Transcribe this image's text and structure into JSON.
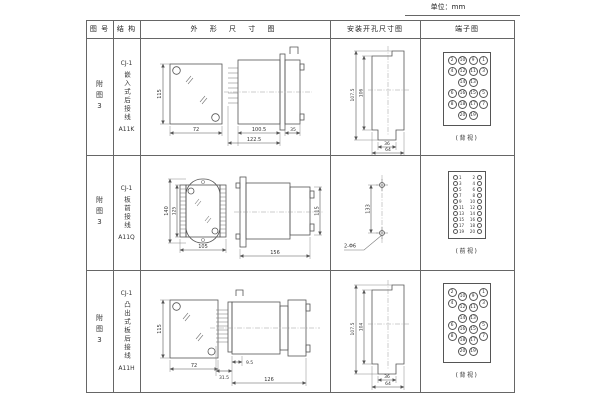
{
  "unit_label": "单位：mm",
  "header": {
    "figure": "图 号",
    "structure": "结 构",
    "outline": "外 形 尺 寸 图",
    "install": "安装开孔尺寸图",
    "terminal": "端子图"
  },
  "rows": [
    {
      "figure": "附图3",
      "structure": {
        "model": "CJ-1",
        "name": "嵌入式后接线",
        "code": "A11K"
      },
      "outline": {
        "front_height": "115",
        "front_width": "72",
        "depth_body": "100.5",
        "depth_total": "122.5",
        "front_depth": "35"
      },
      "install": {
        "outer_height": "107.5",
        "inner_height": "106",
        "inner_width": "36",
        "outer_width": "64"
      },
      "terminal": {
        "style": "grid",
        "rows": [
          [
            "2",
            "10",
            "9",
            "1"
          ],
          [
            "4",
            "12",
            "11",
            "3"
          ],
          [
            "",
            "14",
            "13",
            ""
          ],
          [
            "6",
            "16",
            "15",
            "5"
          ],
          [
            "8",
            "18",
            "17",
            "7"
          ],
          [
            "",
            "20",
            "19",
            ""
          ]
        ],
        "caption": "(背视)"
      }
    },
    {
      "figure": "附图3",
      "structure": {
        "model": "CJ-1",
        "name": "板前接线",
        "code": "A11Q"
      },
      "outline": {
        "front_height_outer": "140",
        "front_height_inner": "125",
        "front_width": "105",
        "side_length": "156",
        "side_height": "115"
      },
      "install": {
        "hole_spacing": "133",
        "hole_note": "2-Φ6"
      },
      "terminal": {
        "style": "dual",
        "pairs": [
          [
            "1",
            "2"
          ],
          [
            "3",
            "4"
          ],
          [
            "5",
            "6"
          ],
          [
            "7",
            "8"
          ],
          [
            "9",
            "10"
          ],
          [
            "11",
            "12"
          ],
          [
            "13",
            "14"
          ],
          [
            "15",
            "16"
          ],
          [
            "17",
            "18"
          ],
          [
            "19",
            "20"
          ]
        ],
        "caption": "(前视)"
      }
    },
    {
      "figure": "附图3",
      "structure": {
        "model": "CJ-1",
        "name": "凸出式板后接线",
        "code": "A11H"
      },
      "outline": {
        "front_height": "115",
        "front_width": "72",
        "pin_depth": "31.5",
        "gap": "9.5",
        "depth_total": "126"
      },
      "install": {
        "outer_height": "107.5",
        "inner_height": "104",
        "inner_width": "36",
        "outer_width": "64"
      },
      "terminal": {
        "style": "staggered",
        "rows": [
          [
            "2",
            "10",
            "9",
            "1"
          ],
          [
            "4",
            "12",
            "11",
            "3"
          ],
          [
            "",
            "14",
            "13",
            ""
          ],
          [
            "6",
            "16",
            "15",
            "5"
          ],
          [
            "8",
            "18",
            "17",
            "7"
          ],
          [
            "",
            "20",
            "19",
            ""
          ]
        ],
        "caption": "(背视)"
      }
    }
  ]
}
